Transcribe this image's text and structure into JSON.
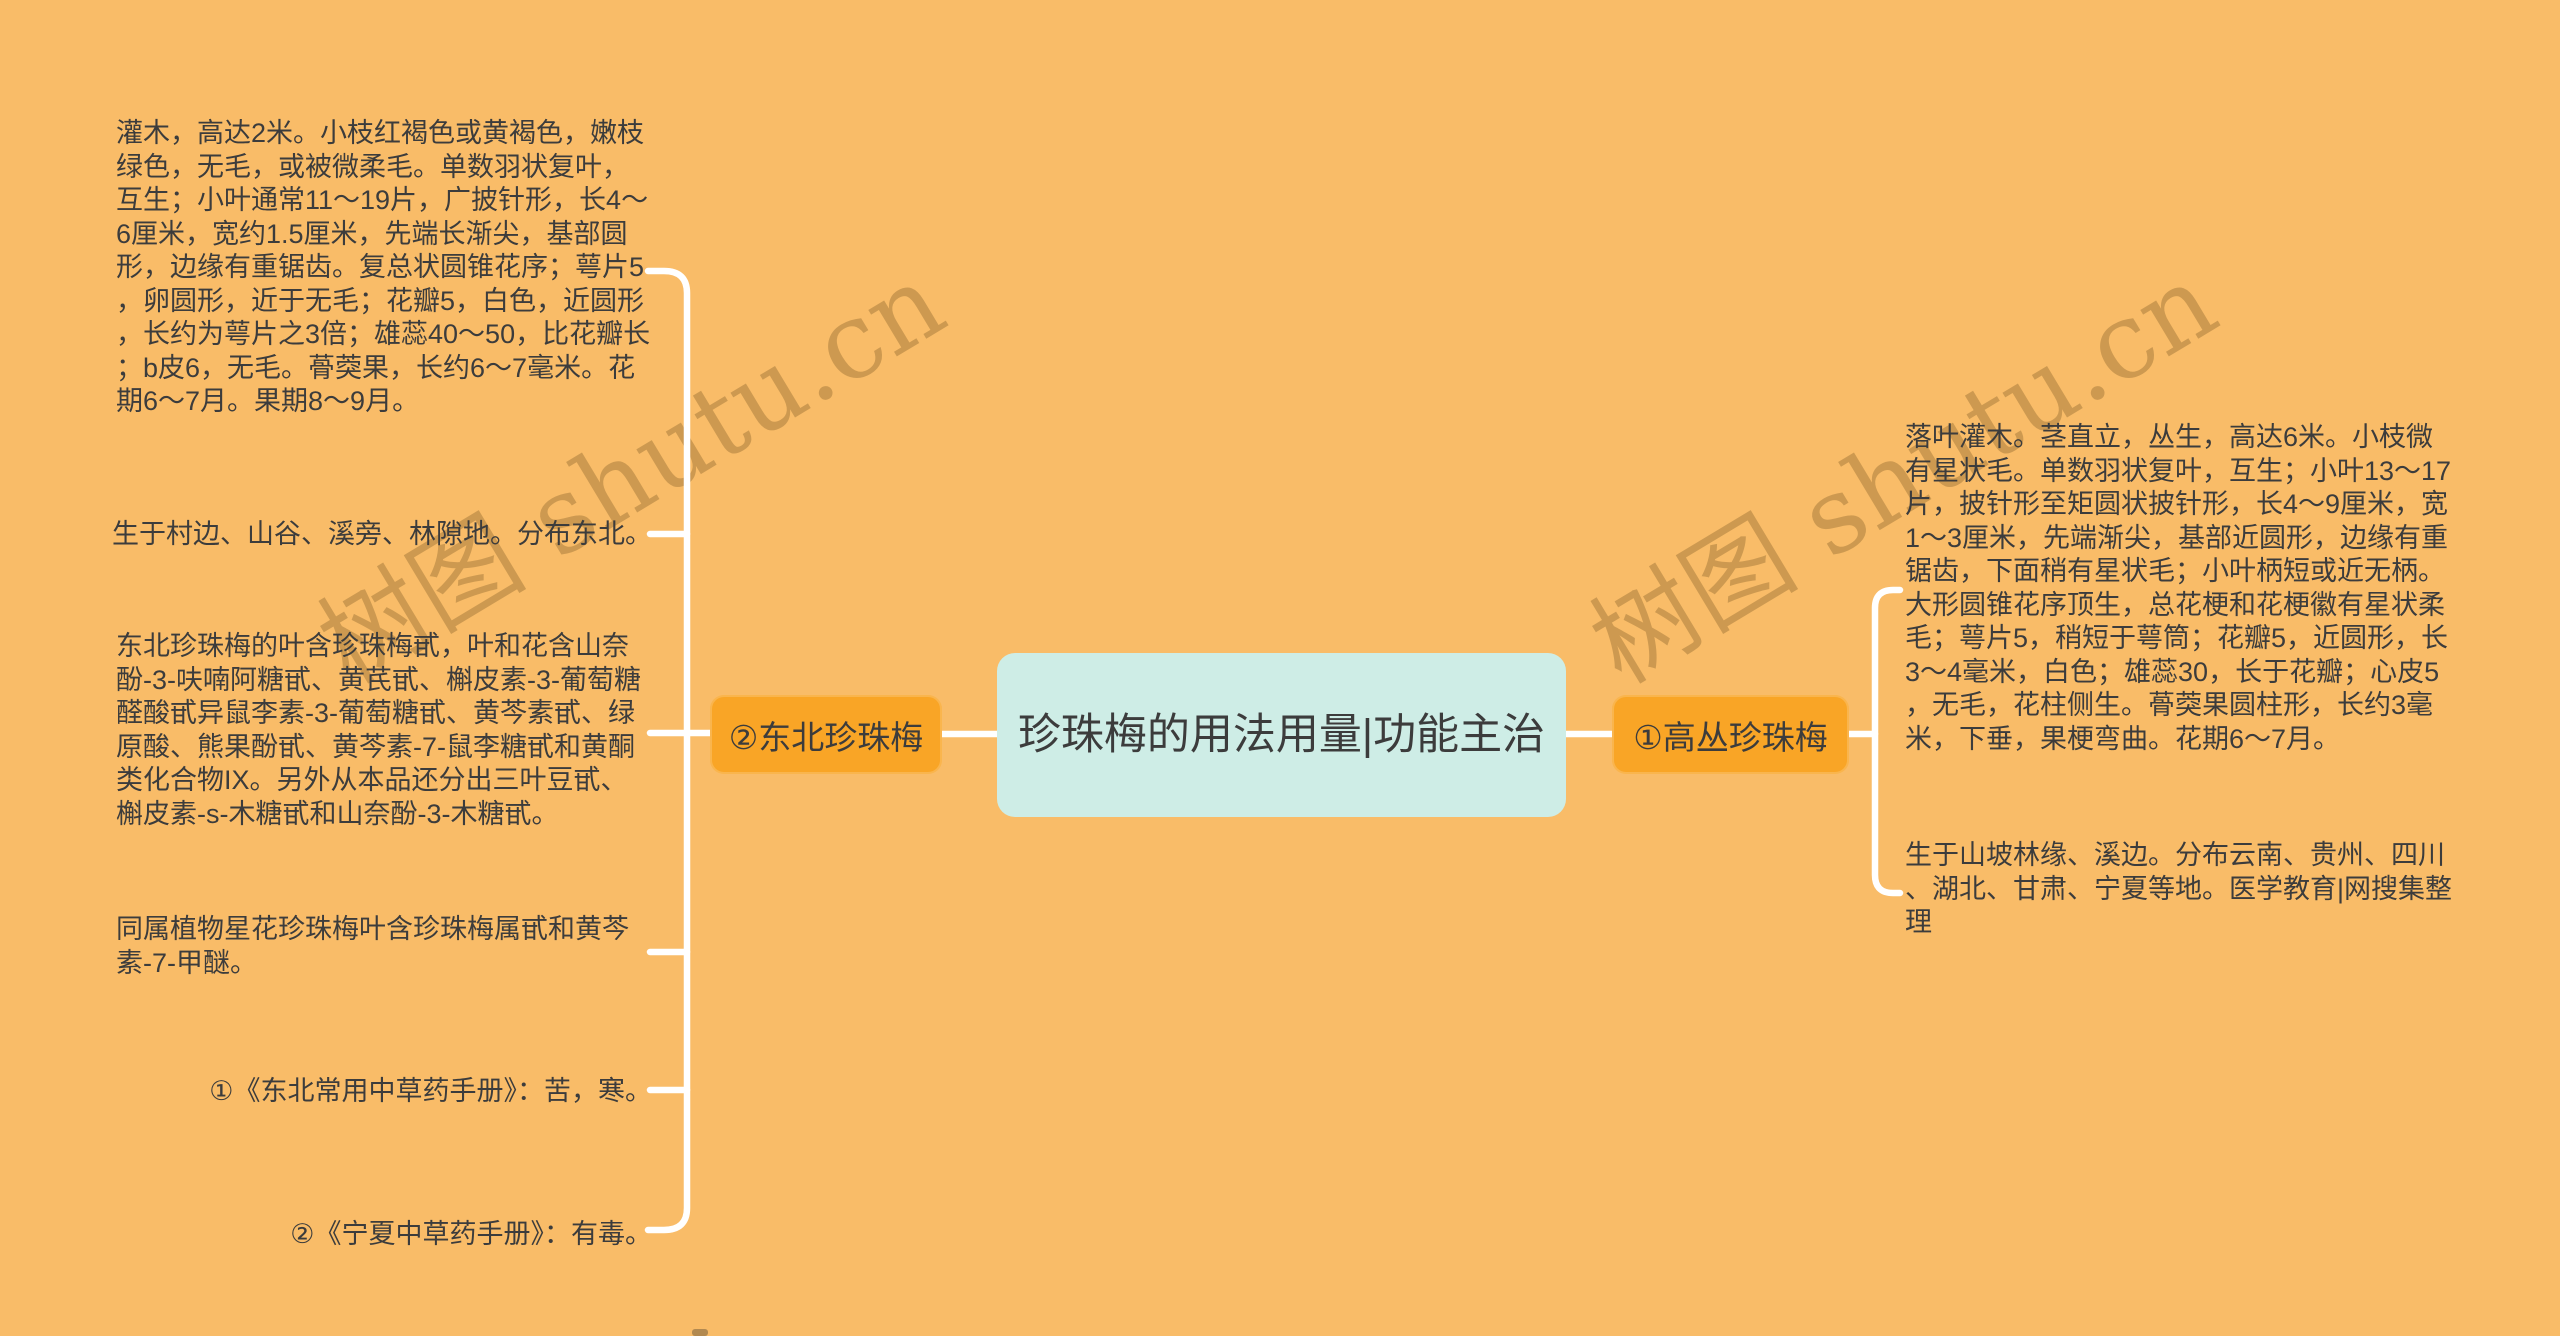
{
  "page": {
    "watermark_text": "树图 shutu.cn",
    "colors": {
      "background": "#F9BC68",
      "branch_node": "#F9A526",
      "center_node": "#CEEDE6",
      "connector": "#FFFFFF",
      "text": "#3C3C3C",
      "watermark": "#86622B"
    }
  },
  "center": {
    "title": "珍珠梅的用法用量|功能主治"
  },
  "branches": [
    {
      "side": "left",
      "label": "②东北珍珠梅",
      "notes": [
        "灌木，高达2米。小枝红褐色或黄褐色，嫩枝绿色，无毛，或被微柔毛。单数羽状复叶，互生；小叶通常11～19片，广披针形，长4～6厘米，宽约1.5厘米，先端长渐尖，基部圆形，边缘有重锯齿。复总状圆锥花序；萼片5，卵圆形，近于无毛；花瓣5，白色，近圆形，长约为萼片之3倍；雄蕊40～50，比花瓣长；b皮6，无毛。蓇葖果，长约6～7毫米。花期6～7月。果期8～9月。",
        "生于村边、山谷、溪旁、林隙地。分布东北。",
        "东北珍珠梅的叶含珍珠梅甙，叶和花含山奈酚-3-呋喃阿糖甙、黄芪甙、槲皮素-3-葡萄糖醛酸甙异鼠李素-3-葡萄糖甙、黄芩素甙、绿原酸、熊果酚甙、黄芩素-7-鼠李糖甙和黄酮类化合物IX。另外从本品还分出三叶豆甙、槲皮素-s-木糖甙和山奈酚-3-木糖甙。",
        "同属植物星花珍珠梅叶含珍珠梅属甙和黄芩素-7-甲醚。",
        "①《东北常用中草药手册》：苦，寒。",
        "②《宁夏中草药手册》：有毒。"
      ]
    },
    {
      "side": "right",
      "label": "①高丛珍珠梅",
      "notes": [
        "落叶灌木。茎直立，丛生，高达6米。小枝微有星状毛。单数羽状复叶，互生；小叶13～17片，披针形至矩圆状披针形，长4～9厘米，宽1～3厘米，先端渐尖，基部近圆形，边缘有重锯齿，下面稍有星状毛；小叶柄短或近无柄。大形圆锥花序顶生，总花梗和花梗徽有星状柔毛；萼片5，稍短于萼筒；花瓣5，近圆形，长3～4毫米，白色；雄蕊30，长于花瓣；心皮5，无毛，花柱侧生。蓇葖果圆柱形，长约3毫米，下垂，果梗弯曲。花期6～7月。",
        "生于山坡林缘、溪边。分布云南、贵州、四川、湖北、甘肃、宁夏等地。医学教育|网搜集整理"
      ]
    }
  ]
}
